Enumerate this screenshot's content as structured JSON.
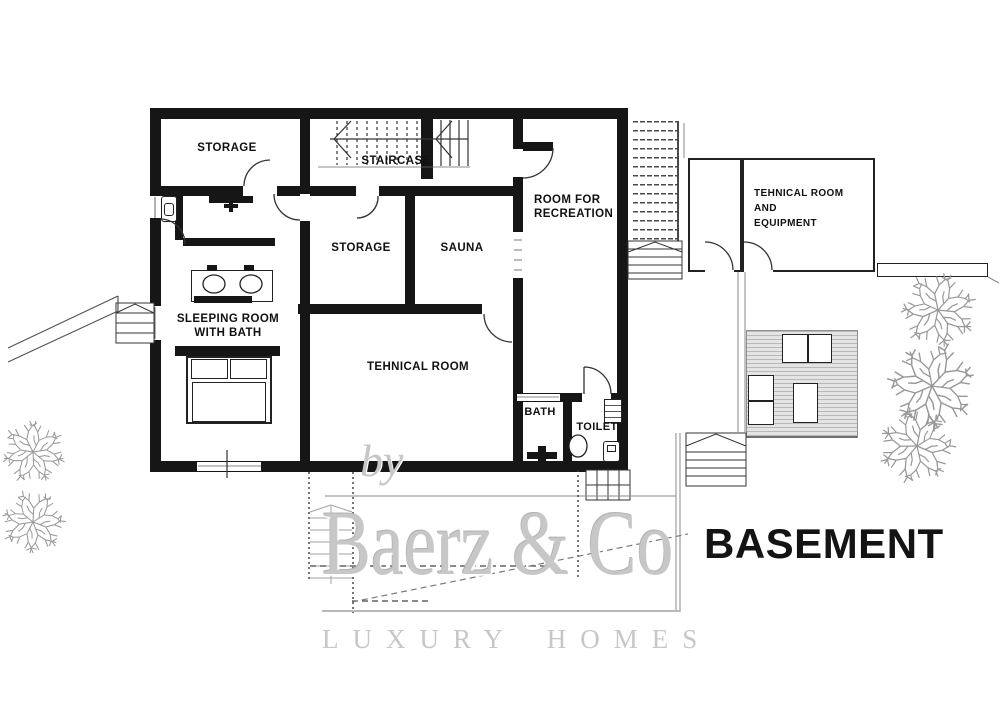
{
  "plan": {
    "title": "BASEMENT"
  },
  "rooms": {
    "storage_a": "STORAGE",
    "staircase": "STAIRCASE",
    "storage_b": "STORAGE",
    "sauna": "SAUNA",
    "recreation": "ROOM FOR\nRECREATION",
    "sleeping": "SLEEPING ROOM\nWITH BATH",
    "technical": "TEHNICAL ROOM",
    "bath": "BATH",
    "toilet": "TOILET",
    "annex_technical": "TEHNICAL ROOM\nAND\nEQUIPMENT"
  },
  "watermark": {
    "prefix": "by",
    "brand": "Baerz & Co",
    "tagline": "LUXURY HOMES"
  },
  "colors": {
    "paper": "#ffffff",
    "wall": "#161616",
    "thin_line": "#4a4a4a",
    "gray_line": "#8a8a8a",
    "tree": "#989898",
    "deck_fill": "#e4e4e4",
    "deck_line": "#b9b9b9",
    "watermark": "#c7c7c7",
    "title": "#141414"
  }
}
